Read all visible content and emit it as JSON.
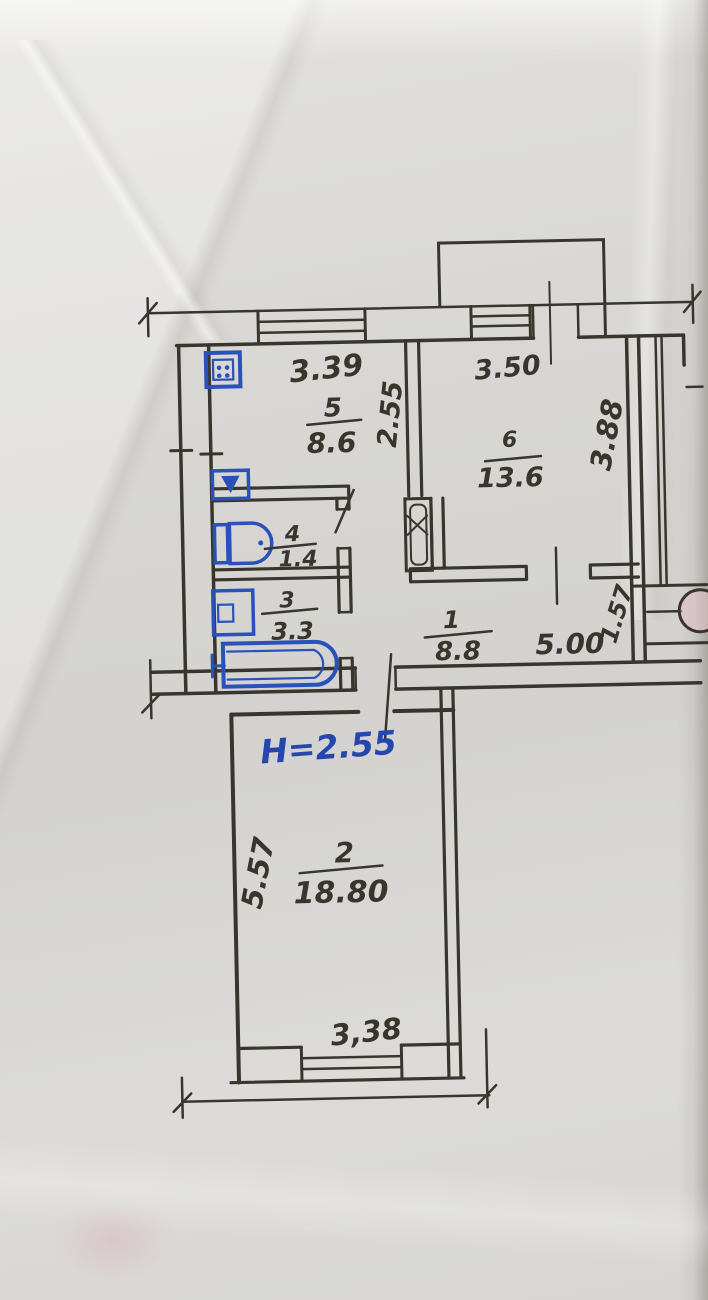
{
  "plan": {
    "height_note": "H=2.55",
    "rooms": [
      {
        "id": "5",
        "area": "8.6"
      },
      {
        "id": "6",
        "area": "13.6"
      },
      {
        "id": "4",
        "area": "1.4"
      },
      {
        "id": "3",
        "area": "3.3"
      },
      {
        "id": "1",
        "area": "8.8"
      },
      {
        "id": "2",
        "area": "18.80"
      }
    ],
    "dims": {
      "kitchen_width": "3.39",
      "kitchen_depth": "2.55",
      "room6_width": "3.50",
      "room6_depth": "3.88",
      "hall_width": "5.00",
      "entry_depth": "1.57",
      "living_depth": "5.57",
      "living_width": "3,38"
    },
    "fixtures": [
      "stove",
      "kitchen-sink",
      "toilet",
      "washbasin",
      "bathtub"
    ],
    "colors": {
      "ink": "#39352d",
      "blue_ink": "#2446ad",
      "blue_fixture": "#2950bb",
      "paper": "#d6d5d2",
      "stamp_pink": "#dfb8c0"
    }
  }
}
